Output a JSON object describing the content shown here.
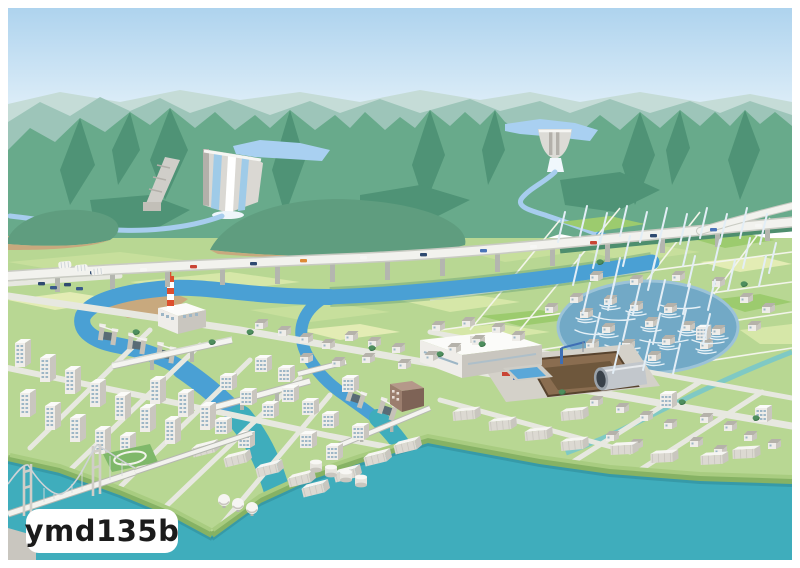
{
  "badge": {
    "text": "ymd135b"
  },
  "palette": {
    "sky_top": "#aed3ee",
    "sky_horizon": "#f0f8fc",
    "ridge_far": "#c5dcd7",
    "ridge_mid": "#9dc5b9",
    "mountain": "#68aa8b",
    "mountain_shadow": "#4f9376",
    "foothill": "#5f9d7f",
    "mountain_tan": "#c8a97e",
    "plain": "#b8d793",
    "field_light": "#d6e7a8",
    "field_mid": "#c7df9c",
    "field_bright": "#9ccb6e",
    "field_pale": "#e3ecb4",
    "reservoir": "#a9d0f1",
    "river_upper": "#a7cdee",
    "river": "#4aa0d4",
    "sea": "#3fadbc",
    "flood": "#72a9c6",
    "rain": "#e3eef6",
    "road": "#e7e8e0",
    "road_edge": "#c9cbc3",
    "highway": "#f2f2ee",
    "pier": "#b4b6af",
    "embankment": "#4e8e6e",
    "quay_top": "#a8cc80",
    "quay_side": "#86b264",
    "quay_shadow": "#2f8b97",
    "bld_face": "#efede9",
    "bld_side": "#c9c6bf",
    "bld_top": "#fbfbf9",
    "window": "#9db6c6",
    "chimney_red": "#dd4f2e",
    "apron": "#d4d1c9",
    "pit_wall": "#8a6d50",
    "pit_floor": "#6e573c",
    "brown": "#9b7e6e",
    "tree": "#4e8e5e",
    "crane": "#3f6fb5",
    "badge_bg": "#ffffff",
    "badge_text": "#1b1b1b"
  },
  "landmarks": [
    "mountain-range",
    "upstream-dam-left",
    "upstream-dam-right",
    "mountain-stream",
    "main-river",
    "river-weir",
    "floodgates",
    "highway-viaduct",
    "farmland",
    "rain-shower",
    "flooded-area",
    "underground-reservoir-construction",
    "factory-with-chimney",
    "city",
    "harbor",
    "suspension-bridge",
    "sea"
  ]
}
